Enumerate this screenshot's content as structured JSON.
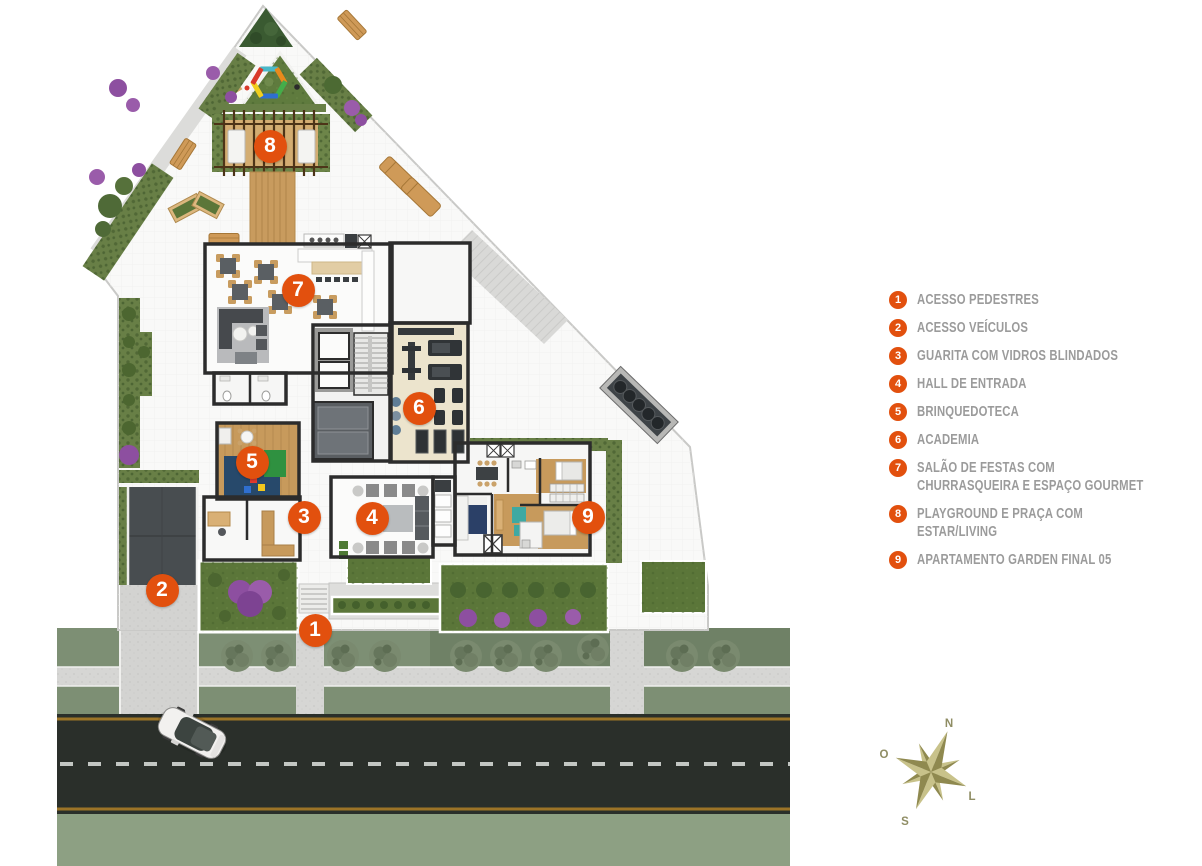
{
  "colors": {
    "accent": "#E2500E",
    "legend_text": "#9B9B9B",
    "compass_text": "#8F8D64",
    "lawn_green": "#5B7639",
    "street_green": "#7D8F74",
    "road_asphalt": "#2A2F2A"
  },
  "legend": {
    "items": [
      {
        "number": "1",
        "label": "ACESSO PEDESTRES"
      },
      {
        "number": "2",
        "label": "ACESSO VEÍCULOS"
      },
      {
        "number": "3",
        "label": "GUARITA COM VIDROS BLINDADOS"
      },
      {
        "number": "4",
        "label": "HALL DE ENTRADA"
      },
      {
        "number": "5",
        "label": "BRINQUEDOTECA"
      },
      {
        "number": "6",
        "label": "ACADEMIA"
      },
      {
        "number": "7",
        "label": "SALÃO DE FESTAS COM CHURRASQUEIRA E ESPAÇO GOURMET"
      },
      {
        "number": "8",
        "label": "PLAYGROUND E PRAÇA COM ESTAR/LIVING"
      },
      {
        "number": "9",
        "label": "APARTAMENTO GARDEN FINAL 05"
      }
    ]
  },
  "plan": {
    "markers": [
      {
        "number": "1",
        "x": 315,
        "y": 630
      },
      {
        "number": "2",
        "x": 162,
        "y": 590
      },
      {
        "number": "3",
        "x": 304,
        "y": 517
      },
      {
        "number": "4",
        "x": 372,
        "y": 518
      },
      {
        "number": "5",
        "x": 252,
        "y": 462
      },
      {
        "number": "6",
        "x": 419,
        "y": 408
      },
      {
        "number": "7",
        "x": 298,
        "y": 290
      },
      {
        "number": "8",
        "x": 270,
        "y": 146
      },
      {
        "number": "9",
        "x": 588,
        "y": 517
      }
    ]
  },
  "compass": {
    "n": "N",
    "o": "O",
    "l": "L",
    "s": "S"
  }
}
